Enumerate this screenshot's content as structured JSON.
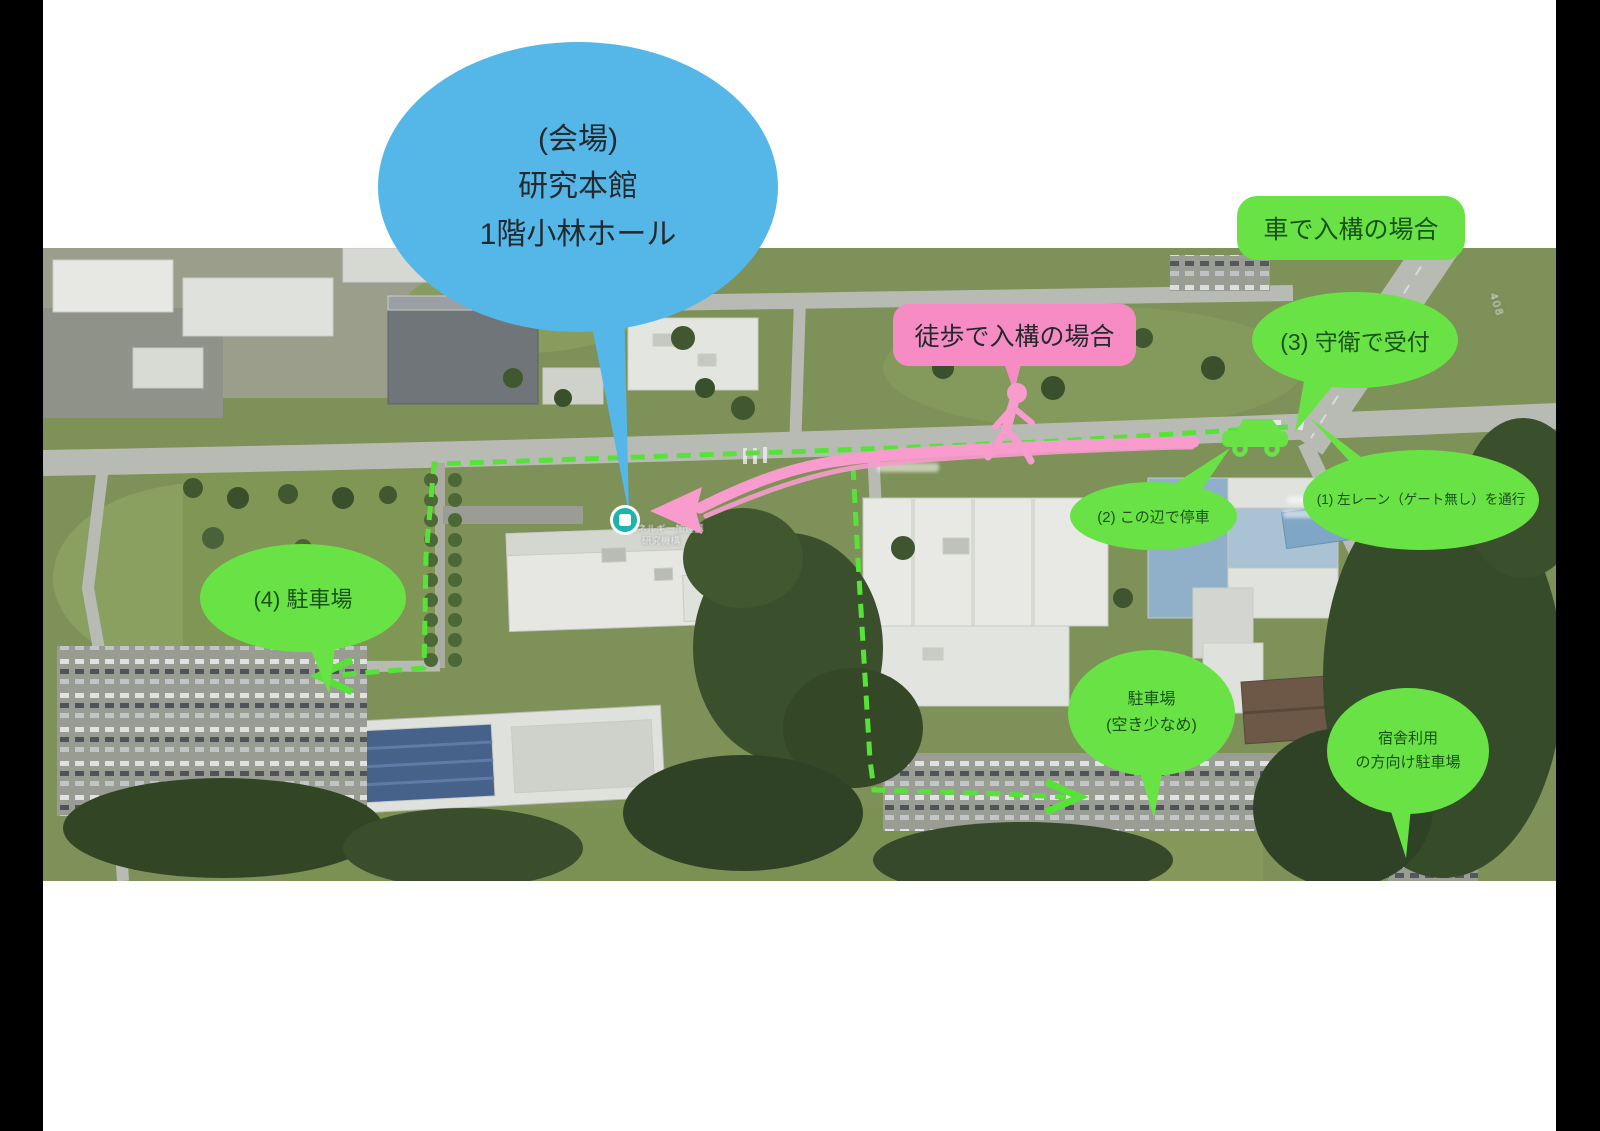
{
  "colors": {
    "bubble_blue": "#55b7e8",
    "bubble_pink": "#f78cc4",
    "bubble_green": "#69e246",
    "route_green": "#57e23a",
    "route_pink": "#f79ccd",
    "text_dark": "#24292e",
    "text_green": "#1b511b",
    "marker_teal": "#1cb5ad",
    "bar_black": "#000000"
  },
  "annotations": {
    "venue": {
      "lines": [
        "(会場)",
        "研究本館",
        "1階小林ホール"
      ]
    },
    "walk": {
      "label": "徒歩で入構の場合"
    },
    "car": {
      "label": "車で入構の場合"
    },
    "step1": {
      "label": "(1) 左レーン（ゲート無し）を通行"
    },
    "step2": {
      "label": "(2) この辺で停車"
    },
    "step3": {
      "label": "(3) 守衛で受付"
    },
    "step4": {
      "label": "(4) 駐車場"
    },
    "parking_few": {
      "lines": [
        "駐車場",
        "(空き少なめ)"
      ]
    },
    "parking_lodge": {
      "lines": [
        "宿舎利用",
        "の方向け駐車場"
      ]
    }
  },
  "map": {
    "marker_label_lines": [
      "高エネルギー加速器",
      "研究機構"
    ],
    "road_label": "408"
  }
}
